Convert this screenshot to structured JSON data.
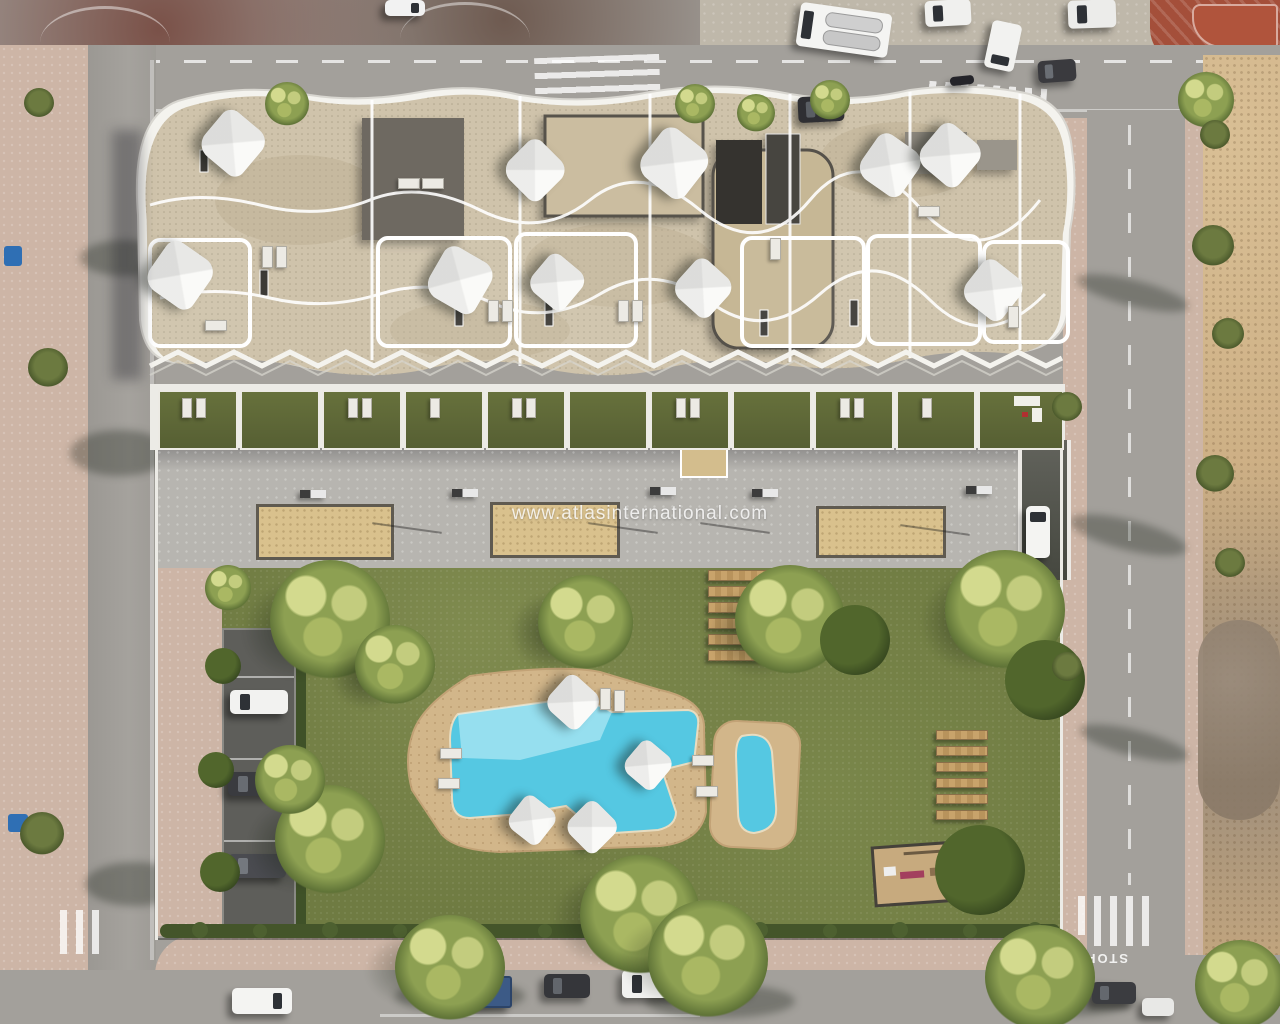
{
  "watermark": {
    "text": "www.atlasinternational.com"
  },
  "road_markings": {
    "stop": "STOP"
  },
  "palette": {
    "asphalt": "#a3a09b",
    "asphalt_dark": "#8f8b86",
    "sidewalk": "#cdb5a6",
    "sidewalk_light": "#bfb8aa",
    "dirt": "#c9aa7f",
    "lawn": "#6f7b42",
    "plaza": "#b7b5b0",
    "roof_stone": "#cfc3ab",
    "roof_gravel": "#c7b795",
    "roof_dark": "#6e6961",
    "railing": "#f4f3ee",
    "pool_deck": "#d2b68a",
    "water": "#55c8e2",
    "water_light": "#aee6f2",
    "sand_court": "#d9c18d",
    "tree_dark": "#3f5226",
    "tree_light": "#c0ca7d",
    "brick": "#a44f3a",
    "wall_white": "#ecebe6"
  }
}
